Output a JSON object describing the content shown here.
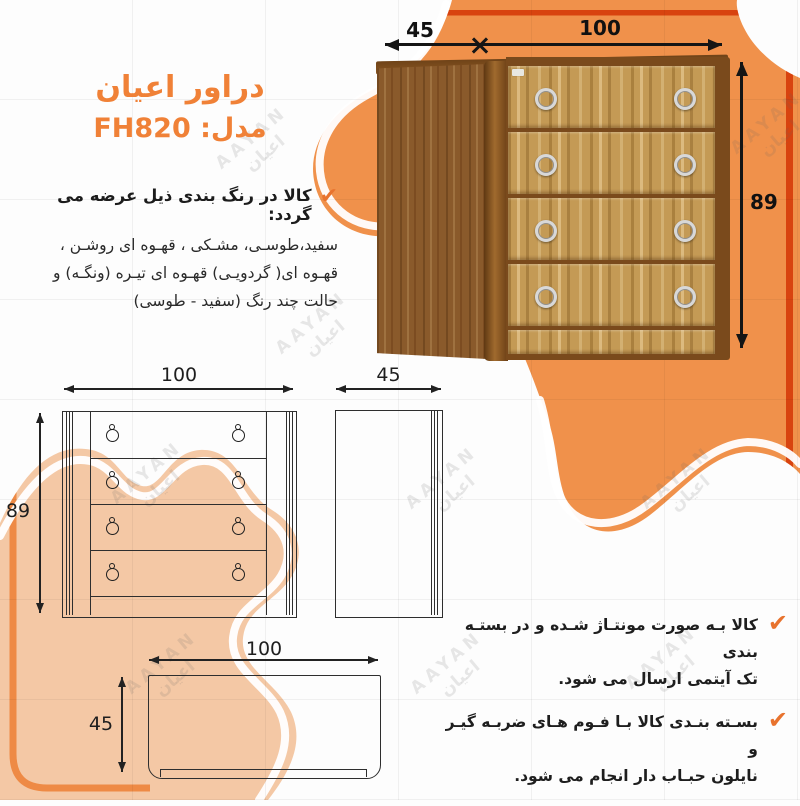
{
  "header": {
    "title": "دراور اعیان",
    "model": "مدل: FH820"
  },
  "colors": {
    "accent_orange": "#F0914B",
    "deep_orange": "#D8430F",
    "peach": "#F4C8A5",
    "title_orange": "#F08137",
    "check_orange": "#E8732E",
    "ink": "#222222"
  },
  "icons": {
    "check": "✔"
  },
  "color_note": {
    "heading": "کالا در رنگ بندی ذیل عرضه می گردد:",
    "lines": [
      "سفید،طوسـی، مشـکی ، قهـوه ای روشـن ،",
      "قهـوه ای( گردویـی) قهـوه ای تیـره (ونگـه) و",
      "حالت چند رنگ (سفید - طوسی)"
    ]
  },
  "dimensions_3d": {
    "depth": "45",
    "width": "100",
    "height": "89"
  },
  "front_view": {
    "width": "100",
    "height": "89"
  },
  "side_view": {
    "width": "45"
  },
  "top_view": {
    "width": "100",
    "depth": "45"
  },
  "shipping_notes": [
    {
      "line1": "کالا بـه صورت مونتـاژ شـده و در بستـه بندی",
      "line2": "تک آیتمی ارسال می شود."
    },
    {
      "line1": "بسـته بنـدی کالا بـا فـوم هـای ضربـه گیـر و",
      "line2": "نایلون حبـاب دار انجام می شود."
    }
  ],
  "watermark": {
    "latin": "AAYAN",
    "farsi": "اعیان"
  }
}
